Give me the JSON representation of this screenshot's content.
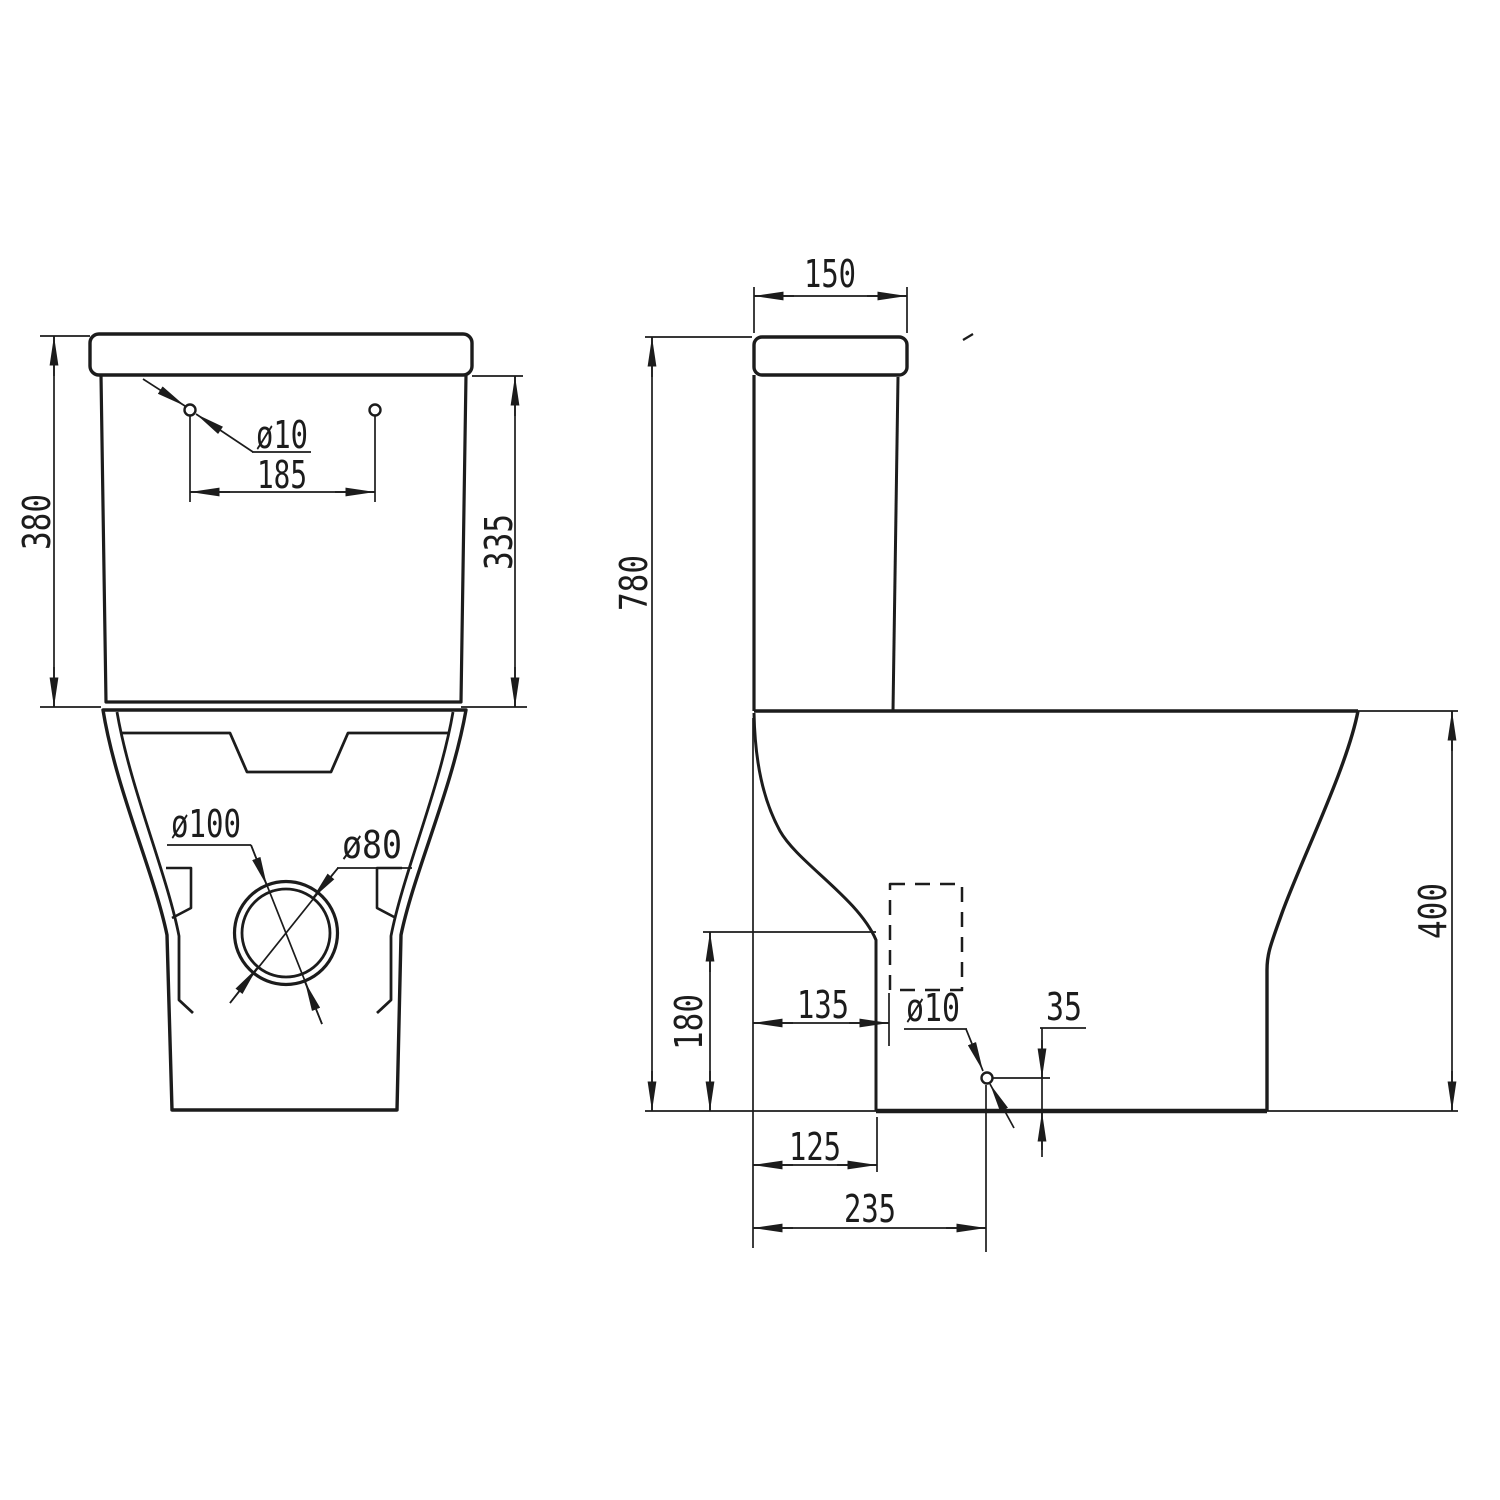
{
  "style": {
    "background_color": "#ffffff",
    "line_color": "#1c1c1c"
  },
  "front_view": {
    "dims": {
      "overall_height": "380",
      "tank_height": "335",
      "hole_spacing": "185",
      "hole_diameter": "ø10",
      "outlet_outer_diameter": "ø100",
      "outlet_inner_diameter": "ø80"
    }
  },
  "side_view": {
    "dims": {
      "cistern_depth": "150",
      "overall_height": "780",
      "rear_face_height": "180",
      "outlet_setback": "135",
      "hole_diameter": "ø10",
      "hole_center_height": "35",
      "pan_height": "400",
      "pan_rear_setback": "125",
      "hole_setback": "235"
    }
  }
}
